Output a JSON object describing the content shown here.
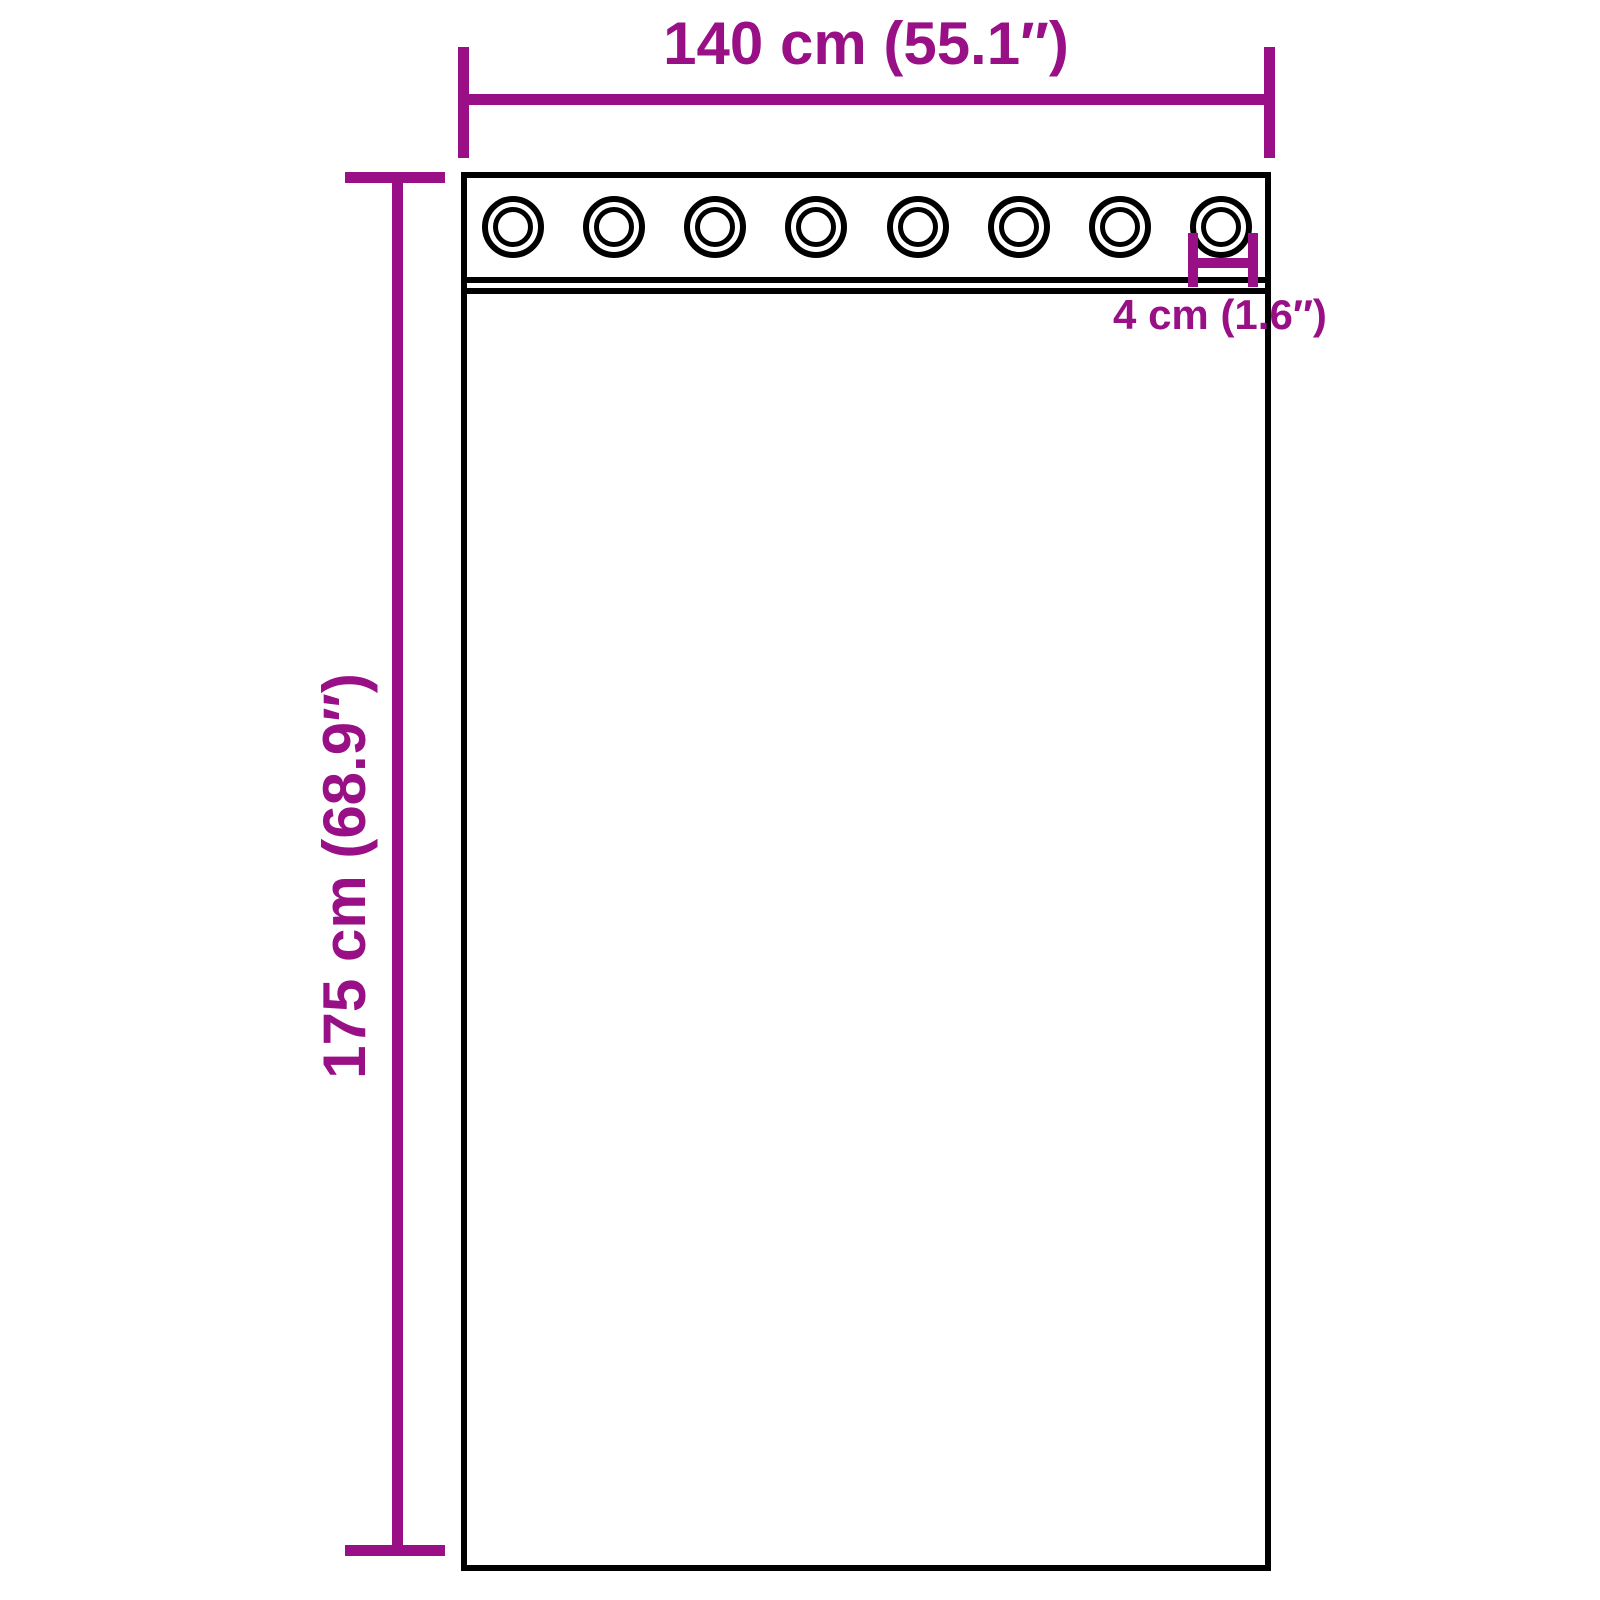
{
  "diagram": {
    "type": "product-dimension-diagram",
    "subject": "curtain panel with grommets",
    "background_color": "#ffffff",
    "outline_color": "#000000",
    "accent_color": "#991086",
    "grommet_count": 8,
    "labels": {
      "width": "140 cm (55.1″)",
      "height": "175 cm (68.9″)",
      "grommet_diameter": "4 cm (1.6″)"
    }
  }
}
